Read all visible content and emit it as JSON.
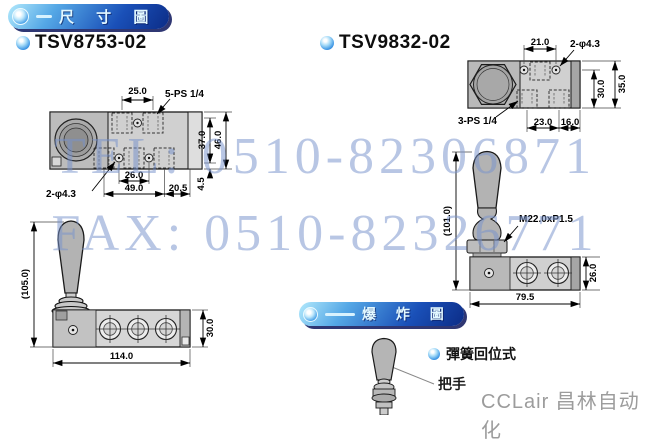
{
  "header": {
    "dimension_title": "尺 寸 圖",
    "explosion_title": "爆 炸 圖"
  },
  "models": {
    "left": "TSV8753-02",
    "right": "TSV9832-02"
  },
  "watermark": {
    "tel": "TEL: 0510-82306871",
    "fax": "FAX: 0510-82326771"
  },
  "tsv8753": {
    "top_view": {
      "pitch": "25.0",
      "ports": "5-PS 1/4",
      "holes": "2-φ4.3",
      "height_inner": "37.0",
      "height_total": "46.0",
      "edge_offset": "4.5",
      "port_span": "26.0",
      "body_len": "49.0",
      "end_len": "20.5"
    },
    "side_view": {
      "total_height": "(105.0)",
      "body_height": "30.0",
      "body_width": "114.0"
    }
  },
  "tsv9832": {
    "top_view": {
      "pitch": "21.0",
      "holes": "2-φ4.3",
      "ports": "3-PS 1/4",
      "height_inner": "30.0",
      "height_total": "35.0",
      "span_a": "23.0",
      "span_b": "16.0"
    },
    "side_view": {
      "total_height": "(101.0)",
      "thread": "M22.0xP1.5",
      "body_height": "26.0",
      "body_width": "79.5"
    }
  },
  "explosion": {
    "type_label": "彈簧回位式",
    "part_label": "把手"
  },
  "brand": {
    "text": "CCLair 昌林自动化"
  },
  "colors": {
    "badge_light": "#b2e9fc",
    "badge_dark": "#0c2c86",
    "watermark_blue": "#7692cc",
    "body_gray": "#d0d0d0"
  }
}
